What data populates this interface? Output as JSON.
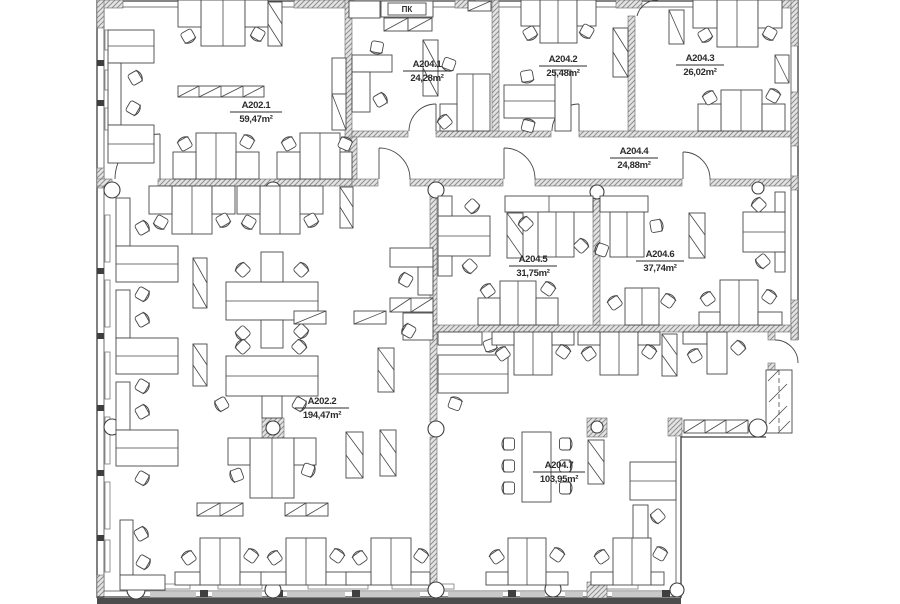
{
  "plan": {
    "equipment_label": "ПК",
    "rooms": [
      {
        "id": "A202.1",
        "area": "59,47m²"
      },
      {
        "id": "A204.1",
        "area": "24,28m²"
      },
      {
        "id": "A204.2",
        "area": "25,48m²"
      },
      {
        "id": "A204.3",
        "area": "26,02m²"
      },
      {
        "id": "A204.4",
        "area": "24,88m²"
      },
      {
        "id": "A204.5",
        "area": "31,75m²"
      },
      {
        "id": "A204.6",
        "area": "37,74m²"
      },
      {
        "id": "A202.2",
        "area": "194,47m²"
      },
      {
        "id": "A204.7",
        "area": "103,95m²"
      }
    ]
  }
}
